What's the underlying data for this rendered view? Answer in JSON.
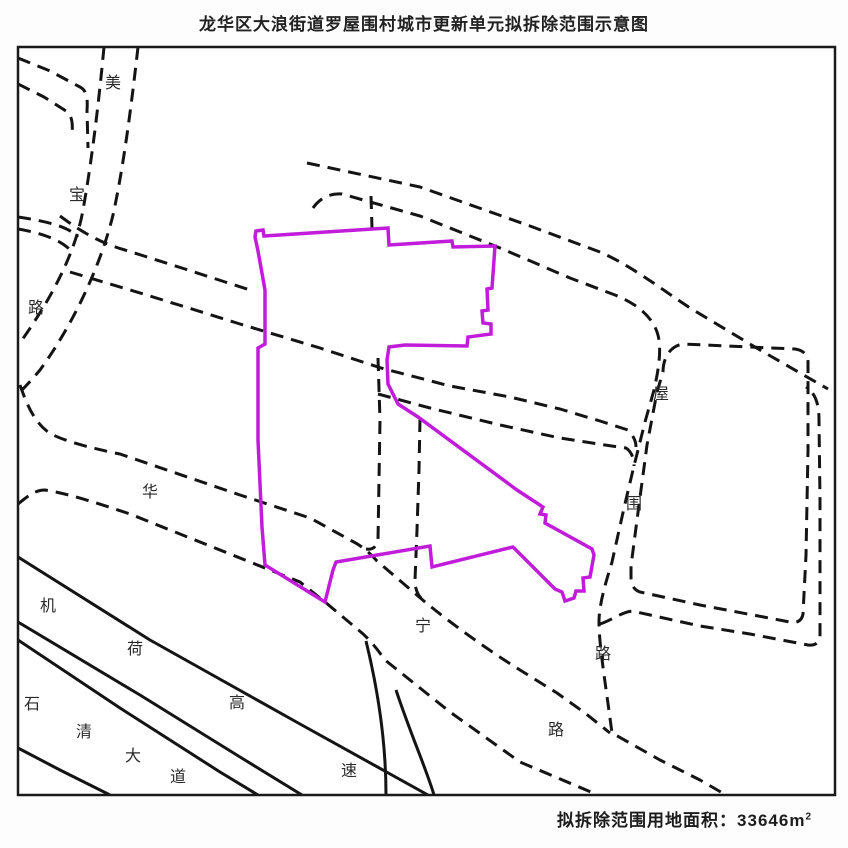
{
  "title": "龙华区大浪街道罗屋围村城市更新单元拟拆除范围示意图",
  "caption": {
    "label": "拟拆除范围用地面积：",
    "value": "33646",
    "unit_base": "m",
    "unit_sup": "2"
  },
  "map": {
    "frame": {
      "x": 18,
      "y": 47,
      "w": 817,
      "h": 748
    },
    "colors": {
      "boundary": "#c21cdb",
      "road": "#141414",
      "border": "#1a1a1a",
      "background": "#ffffff"
    },
    "boundary_path": "M255,237 L256,231 263,230 264,236 388,228 389,245 452,241 453,247 495,246 492,288 487,289 488,310 482,311 483,323 491,324 491,334 468,337 467,346 405,345 389,347 387,360 388,384 398,404 418,417 517,490 543,507 540,514 546,515 545,523 592,549 594,555 590,577 583,578 584,591 576,591 574,598 565,601 562,592 555,589 513,547 432,567 430,546 336,562 333,570 325,602 265,565 262,527 258,440 258,348 265,344 265,290 258,251 Z",
    "roads_dashed": [
      {
        "name": "meibao-road-west-line",
        "d": "M104,47 C99,100 92,160 83,210 C75,255 50,300 22,340"
      },
      {
        "name": "meibao-road-east-line",
        "d": "M138,47 C132,100 124,165 113,215 C100,268 72,326 40,370 C30,382 22,390 18,394"
      },
      {
        "name": "northwest-connector-1",
        "d": "M18,58 L50,71 80,87 C86,90 88,97 87,110 L88,148"
      },
      {
        "name": "northwest-connector-2",
        "d": "M18,84 L44,97 66,111 C72,115 73,123 72,135"
      },
      {
        "name": "west-branch-1",
        "d": "M18,217 C45,221 68,226 78,237"
      },
      {
        "name": "west-branch-2",
        "d": "M18,229 C42,233 62,240 72,252"
      },
      {
        "name": "link-road-to-boundary",
        "d": "M60,216 C80,231 100,243 125,250 L185,269 253,291"
      },
      {
        "name": "mid-road-north-line",
        "d": "M70,272 L150,296 240,324 320,348 381,368 L450,386 510,397 560,409 600,421 628,430 C633,435 636,441 636,447"
      },
      {
        "name": "mid-road-south-line",
        "d": "M378,394 L430,408 500,425 560,438 605,445 626,448 C632,452 634,459 634,466"
      },
      {
        "name": "north-road-outer-line",
        "d": "M307,163 L420,187 530,226 600,252 C630,265 660,288 690,308 L760,350 828,389"
      },
      {
        "name": "north-road-inner-wuweilu-west-line",
        "d": "M313,208 C320,198 330,193 342,194 L420,216 500,248 570,278 615,295 C640,305 656,320 659,340 C661,355 658,372 654,390 L645,422 633,470 624,508 612,562 C605,585 599,605 599,622 C599,645 605,680 612,733 L660,760 700,780 726,795"
      },
      {
        "name": "east-branch-outer-line",
        "d": "M600,624 C612,620 622,612 632,611 L700,626 750,634 808,645 C816,646 820,642 820,634 L820,500 819,420 C819,403 815,393 806,387"
      },
      {
        "name": "middle-vertical-road-stub",
        "d": "M371,196 L372,228"
      },
      {
        "name": "middle-vertical-road-1",
        "d": "M378,358 L380,420 379,480 378,540 C377,547 372,550 366,549"
      },
      {
        "name": "middle-vertical-road-2",
        "d": "M420,419 L419,470 417,530 415,580 C415,590 418,596 424,601"
      },
      {
        "name": "huaning-road-north-line",
        "d": "M20,385 C28,408 35,422 48,432 C60,440 90,448 120,454 L240,495 310,518 352,541 C362,546 370,553 377,561 L418,596 C440,615 480,645 520,670 L557,693 585,713 610,733"
      },
      {
        "name": "huaning-road-south-line",
        "d": "M18,504 C28,496 35,490 45,490 C70,494 100,504 130,514 L250,562 300,582 325,602 L362,633 C370,640 378,650 385,660 L450,712 520,762 598,795"
      },
      {
        "name": "east-block-outline",
        "d": "M663,372 C663,358 670,346 683,344 L795,349 C803,350 808,355 808,362 L808,450 806,555 803,614 C802,620 797,624 790,622 L700,605 640,592 C634,590 631,585 631,577 L631,566 637,520 647,445 657,392 Z"
      }
    ],
    "roads_solid": [
      {
        "name": "jihe-expressway-line-1",
        "d": "M18,557 L150,640 300,724 428,795"
      },
      {
        "name": "jihe-expressway-line-2",
        "d": "M18,622 L140,695 240,757 302,795"
      },
      {
        "name": "shiqing-avenue-line-1",
        "d": "M18,640 L120,708 220,772 258,795"
      },
      {
        "name": "shiqing-avenue-line-2",
        "d": "M18,748 L60,770 110,795"
      },
      {
        "name": "ramp-curve-1",
        "d": "M366,641 C378,690 386,740 386,795"
      },
      {
        "name": "ramp-curve-2",
        "d": "M396,690 C412,738 426,768 434,795"
      }
    ],
    "labels": [
      {
        "t": "美",
        "x": 113,
        "y": 84
      },
      {
        "t": "宝",
        "x": 77,
        "y": 196
      },
      {
        "t": "路",
        "x": 36,
        "y": 309
      },
      {
        "t": "华",
        "x": 150,
        "y": 493
      },
      {
        "t": "宁",
        "x": 423,
        "y": 627
      },
      {
        "t": "路",
        "x": 556,
        "y": 731
      },
      {
        "t": "机",
        "x": 48,
        "y": 607
      },
      {
        "t": "荷",
        "x": 135,
        "y": 650
      },
      {
        "t": "高",
        "x": 237,
        "y": 704
      },
      {
        "t": "速",
        "x": 349,
        "y": 772
      },
      {
        "t": "石",
        "x": 32,
        "y": 705
      },
      {
        "t": "清",
        "x": 84,
        "y": 733
      },
      {
        "t": "大",
        "x": 133,
        "y": 757
      },
      {
        "t": "道",
        "x": 178,
        "y": 778
      },
      {
        "t": "屋",
        "x": 661,
        "y": 395
      },
      {
        "t": "围",
        "x": 634,
        "y": 505
      },
      {
        "t": "路",
        "x": 603,
        "y": 655
      }
    ]
  }
}
